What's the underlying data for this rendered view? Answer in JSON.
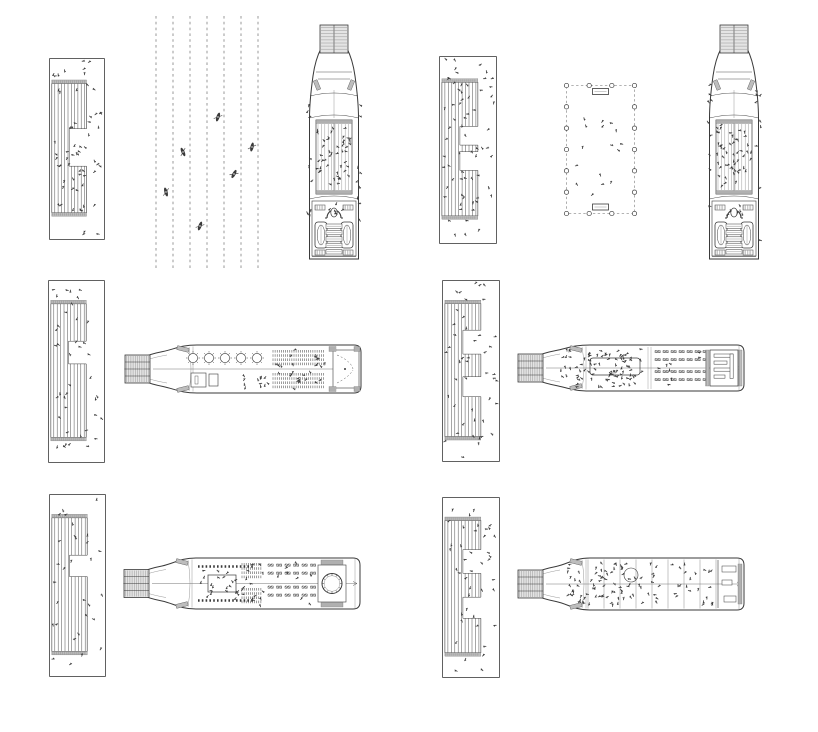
{
  "canvas": {
    "width": 818,
    "height": 732,
    "background": "#ffffff"
  },
  "colors": {
    "ink": "#3a3a3a",
    "faint": "#7d7d7d",
    "dash": "#9a9a9a",
    "hatch_fill": "#e4e4e4",
    "hatch_line": "#8f8f8f",
    "band": "#bdbdbd",
    "white": "#ffffff"
  },
  "panels": [
    {
      "id": "pier-plan-1",
      "type": "pier",
      "rect": [
        49,
        58,
        56,
        182
      ],
      "seed": 11,
      "people_count": 62,
      "stripe": {
        "x0": 0.05,
        "x1": 0.67,
        "y0": 0.14,
        "y1": 0.85
      },
      "notches": [
        [
          0.35,
          0.64
        ]
      ]
    },
    {
      "id": "kayak-lane-plan",
      "type": "lanes",
      "rect": [
        150,
        16,
        114,
        254
      ],
      "lane_count": 7,
      "kayaks": [
        [
          68,
          101,
          18
        ],
        [
          33,
          136,
          -24
        ],
        [
          102,
          131,
          12
        ],
        [
          84,
          158,
          28
        ],
        [
          16,
          176,
          -16
        ],
        [
          50,
          210,
          20
        ]
      ]
    },
    {
      "id": "ship-deck-plan-vertical-1",
      "type": "shipV",
      "rect": [
        306,
        22,
        56,
        240
      ],
      "seed": 21,
      "crowd": 46
    },
    {
      "id": "pier-plan-2",
      "type": "pier",
      "rect": [
        439,
        56,
        58,
        188
      ],
      "seed": 12,
      "people_count": 66,
      "stripe": {
        "x0": 0.05,
        "x1": 0.67,
        "y0": 0.14,
        "y1": 0.85
      },
      "notches": [
        [
          0.33,
          0.47
        ],
        [
          0.52,
          0.66
        ]
      ]
    },
    {
      "id": "colonnade-plan",
      "type": "colonnade",
      "rect": [
        563,
        82,
        75,
        135
      ],
      "cols_top": 4,
      "cols_side": 7,
      "people_count": 16,
      "seed": 41
    },
    {
      "id": "ship-deck-plan-vertical-2",
      "type": "shipV",
      "rect": [
        706,
        22,
        56,
        240
      ],
      "seed": 22,
      "crowd": 50
    },
    {
      "id": "pier-plan-3",
      "type": "pier",
      "rect": [
        48,
        280,
        57,
        183
      ],
      "seed": 13,
      "people_count": 40,
      "stripe": {
        "x0": 0.05,
        "x1": 0.67,
        "y0": 0.13,
        "y1": 0.86
      },
      "notches": [
        [
          0.28,
          0.45
        ]
      ]
    },
    {
      "id": "ship-deck-plan-horizontal-1",
      "type": "shipA",
      "rect": [
        123,
        343,
        240,
        52
      ],
      "seed": 31
    },
    {
      "id": "pier-plan-4",
      "type": "pier",
      "rect": [
        442,
        280,
        58,
        182
      ],
      "seed": 14,
      "people_count": 45,
      "stripe": {
        "x0": 0.05,
        "x1": 0.67,
        "y0": 0.13,
        "y1": 0.86
      },
      "notches": [
        [
          0.2,
          0.38
        ],
        [
          0.55,
          0.7
        ]
      ]
    },
    {
      "id": "ship-deck-plan-horizontal-2",
      "type": "shipB",
      "rect": [
        516,
        343,
        230,
        50
      ],
      "seed": 32
    },
    {
      "id": "pier-plan-5",
      "type": "pier",
      "rect": [
        49,
        494,
        57,
        183
      ],
      "seed": 15,
      "people_count": 30,
      "stripe": {
        "x0": 0.05,
        "x1": 0.67,
        "y0": 0.13,
        "y1": 0.86
      },
      "notches": [
        [
          0.28,
          0.44
        ]
      ]
    },
    {
      "id": "ship-deck-plan-horizontal-3",
      "type": "shipC",
      "rect": [
        122,
        556,
        240,
        55
      ],
      "seed": 33
    },
    {
      "id": "pier-plan-6",
      "type": "pier",
      "rect": [
        442,
        497,
        58,
        181
      ],
      "seed": 16,
      "people_count": 42,
      "stripe": {
        "x0": 0.05,
        "x1": 0.67,
        "y0": 0.13,
        "y1": 0.86
      },
      "notches": [
        [
          0.22,
          0.4
        ],
        [
          0.58,
          0.74
        ]
      ]
    },
    {
      "id": "ship-deck-plan-horizontal-4",
      "type": "shipD",
      "rect": [
        516,
        556,
        230,
        56
      ],
      "seed": 34
    }
  ]
}
